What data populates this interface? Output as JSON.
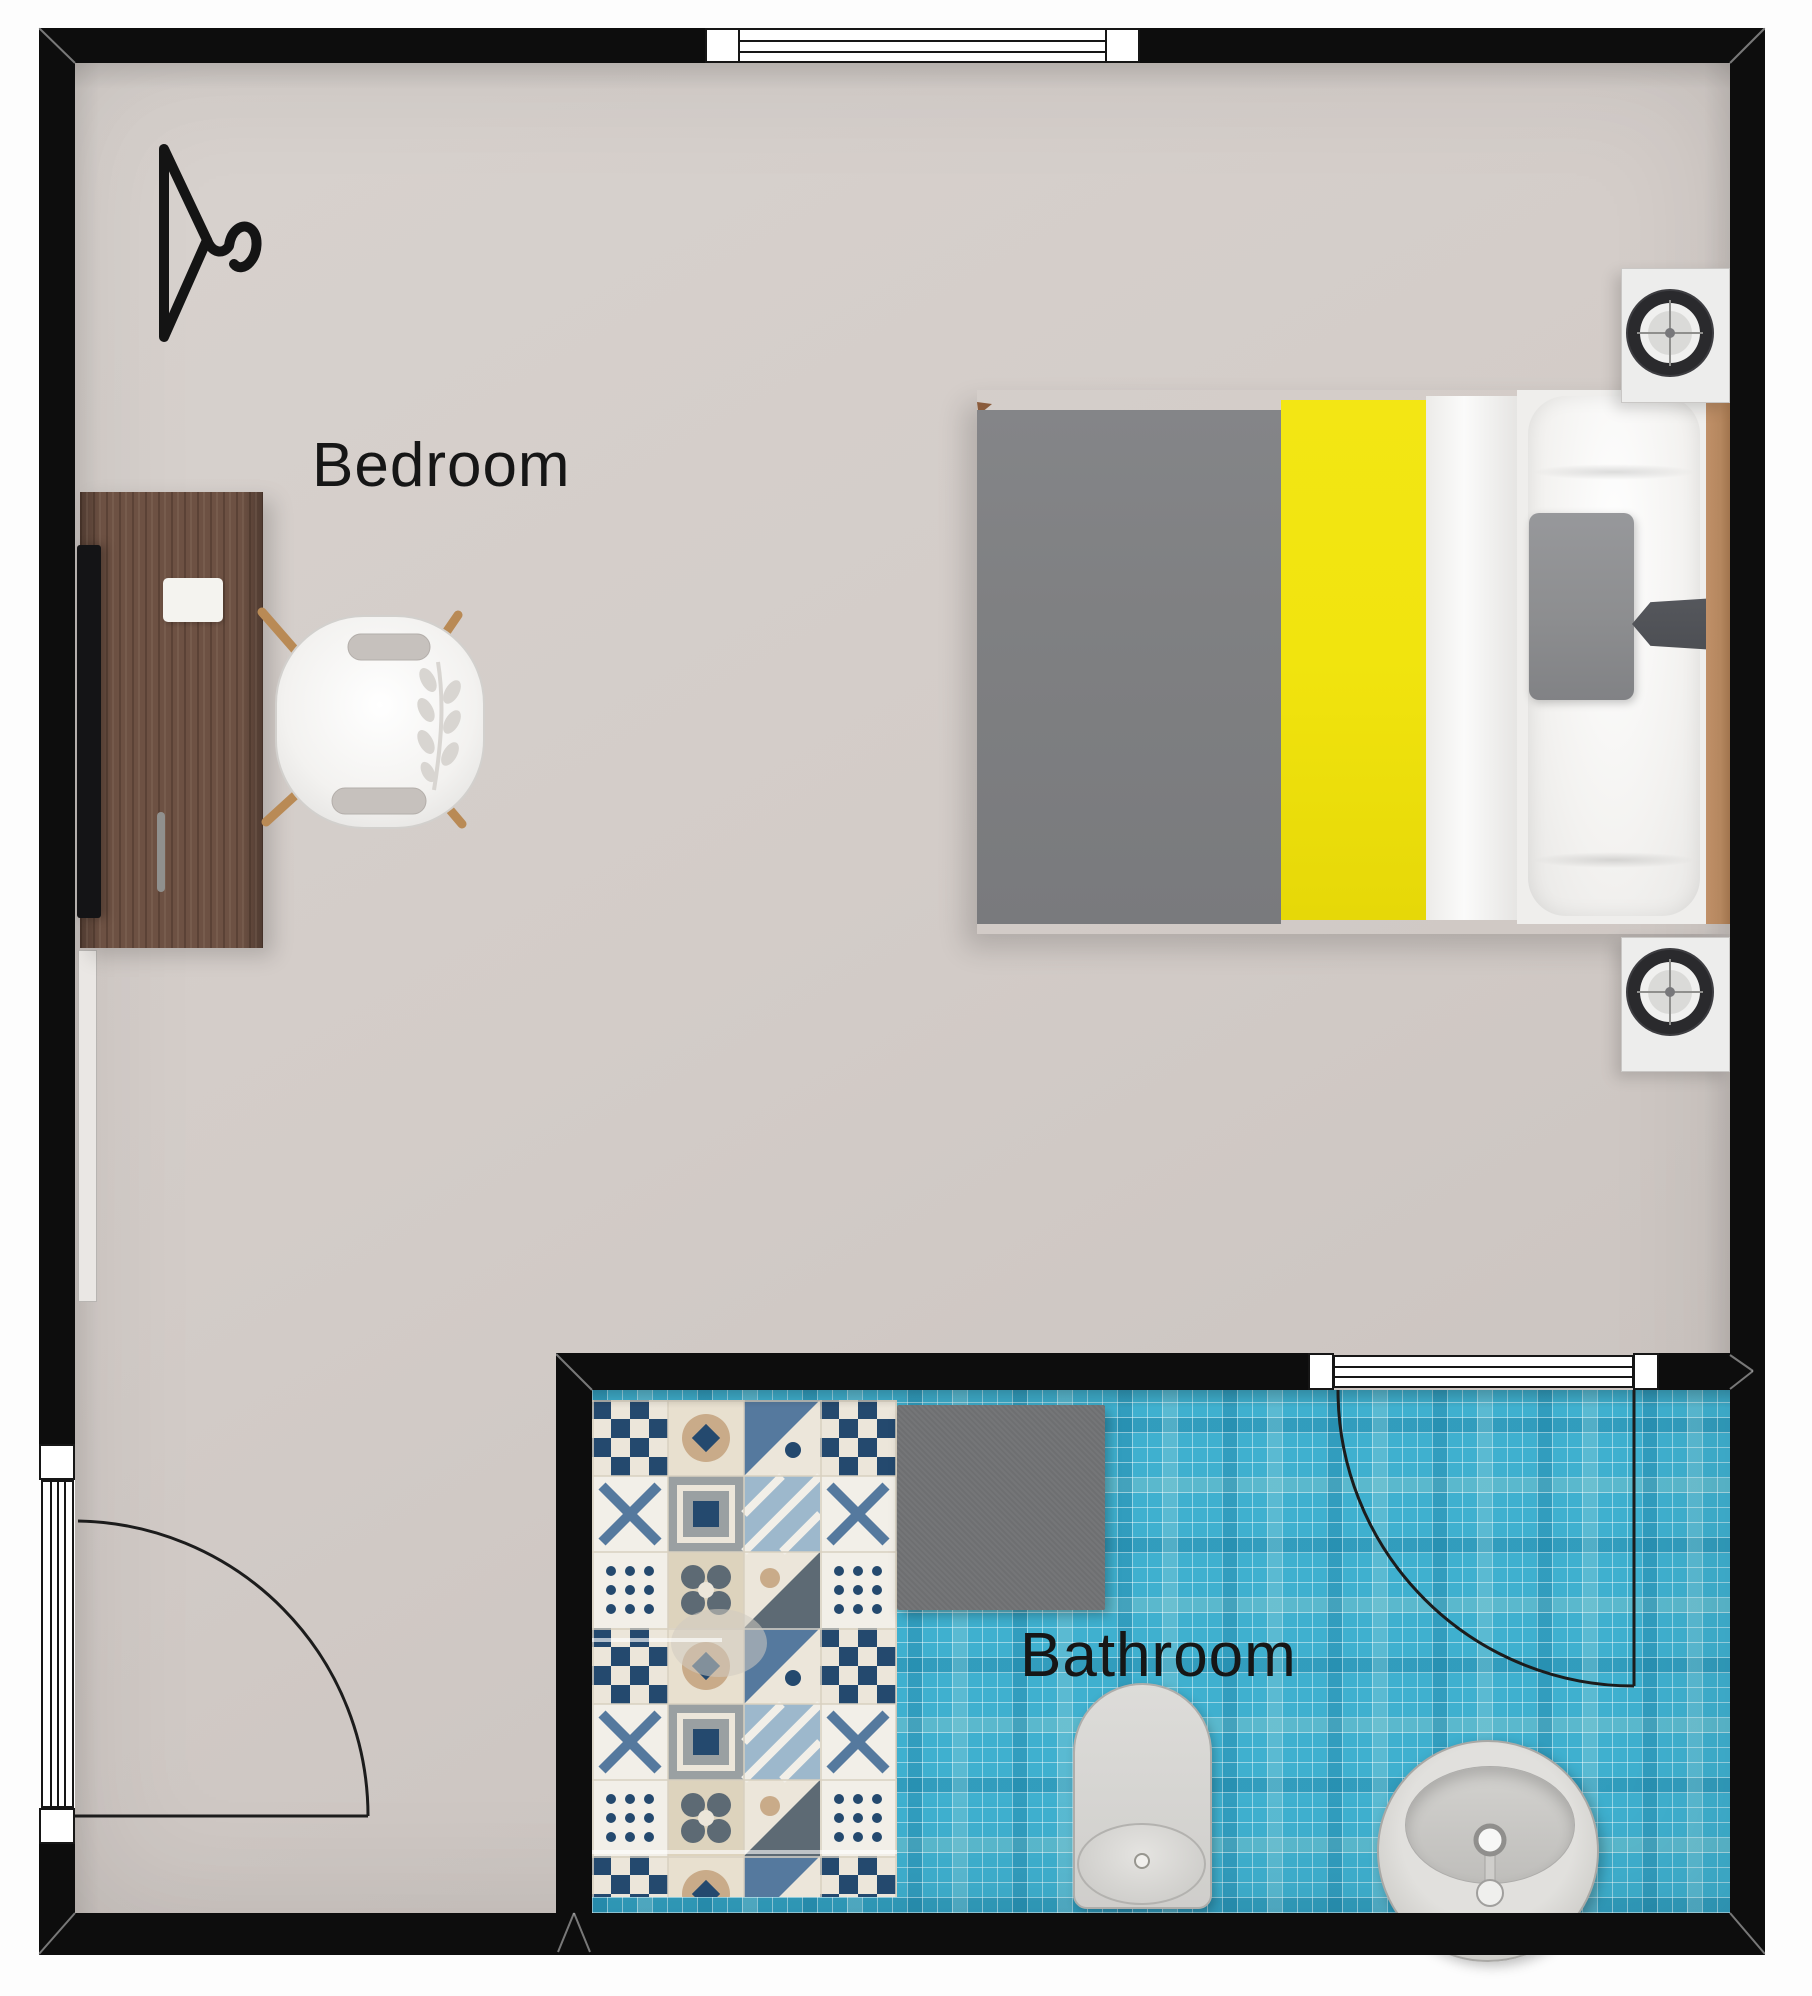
{
  "title": "Bedroom and bathroom floor plan",
  "rooms": {
    "bedroom": {
      "label": "Bedroom"
    },
    "bathroom": {
      "label": "Bathroom"
    }
  },
  "palette": {
    "wall": "#0d0d0d",
    "floor-main": "#d3ccc8",
    "floor-main-dark": "#c8c1bd",
    "tile-blue": "#3fb0cf",
    "mat-gray": "#6e6f71",
    "desk-wood": "#6d5143",
    "headboard-wood": "#b5875f",
    "blanket-gray": "#7f8082",
    "blanket-yellow": "#f1e40e",
    "linen-white": "#f4f3f2",
    "pillow-gray": "#8d8e90",
    "bolster-dark": "#4d4f54",
    "fixture-gray": "#d6d5d2",
    "nightstand": "#ededec",
    "chair-leg-wood": "#b98a55",
    "label-ink": "#161616"
  },
  "objects": {
    "icons": [
      "clothes-hanger-icon",
      "speaker-lamp-icon",
      "door-swing-arc",
      "window-symbol"
    ],
    "furniture": [
      "desk",
      "monitor",
      "desk-chair",
      "radiator",
      "double-bed",
      "pillow",
      "bolster",
      "nightstand",
      "bath-mat",
      "toilet",
      "pedestal-sink"
    ]
  }
}
